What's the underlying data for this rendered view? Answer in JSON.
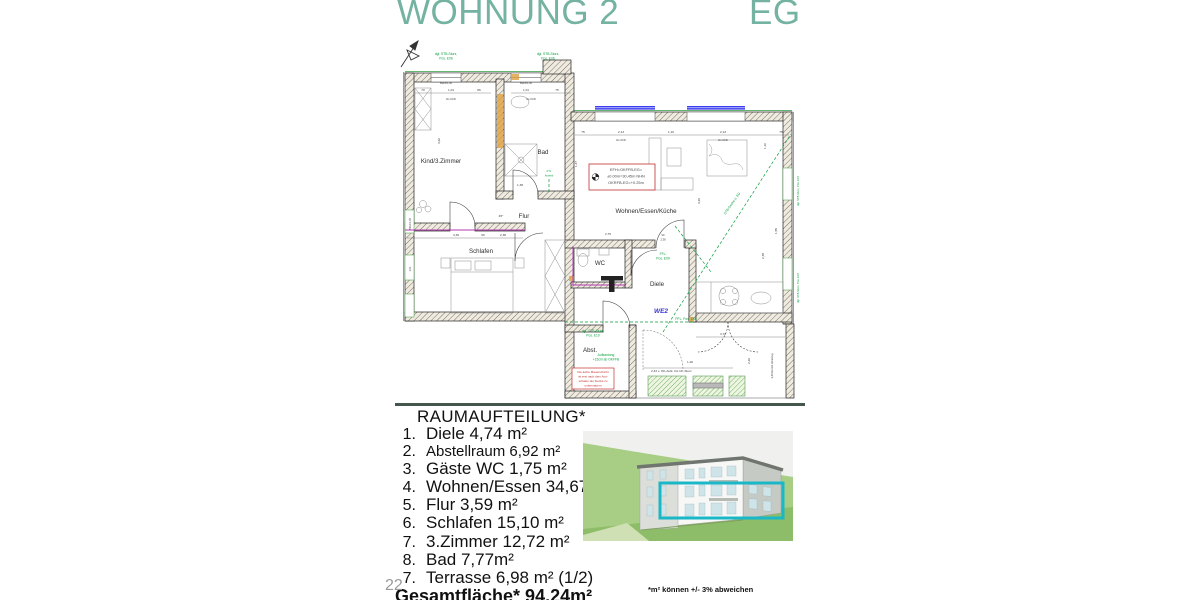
{
  "header": {
    "title": "WOHNUNG 2",
    "floor": "EG"
  },
  "room_list": {
    "heading": "RAUMAUFTEILUNG*",
    "items": [
      {
        "num": "1.",
        "text": "Diele 4,74 m²"
      },
      {
        "num": "2.",
        "text": "Abstellraum 6,92 m²"
      },
      {
        "num": "3.",
        "text": "Gäste WC 1,75 m²"
      },
      {
        "num": "4.",
        "text": "Wohnen/Essen 34,67 m²"
      },
      {
        "num": "5.",
        "text": "Flur 3,59 m²"
      },
      {
        "num": "6.",
        "text": "Schlafen 15,10 m²"
      },
      {
        "num": "7.",
        "text": "3.Zimmer 12,72 m²"
      },
      {
        "num": "8.",
        "text": "Bad 7,77m²"
      },
      {
        "num": "7.",
        "text": "Terrasse 6,98 m² (1/2)"
      }
    ],
    "total": "Gesamtfläche* 94,24m²"
  },
  "footnote": "*m² können +/- 3% abweichen",
  "page_number": "22",
  "floor_plan": {
    "rooms": {
      "kind": "Kind/3.Zimmer",
      "bad": "Bad",
      "flur": "Flur",
      "schlafen": "Schlafen",
      "wc": "WC",
      "diele": "Diele",
      "wohnen": "Wohnen/Essen/Küche",
      "abst": "Abst.",
      "we": "WE2"
    },
    "green": {
      "e06a": "dgl. STB-Sturz,",
      "e06b": "Pos. E06",
      "e07": "dgl. STB-Sturz, Pos. E07",
      "e10a": "dgl. STB-Sturz,",
      "e10b": "Pos. E10",
      "ffla": "FFL,",
      "fflb": "Pos. E09",
      "pfl": "PFL, Pos. E08",
      "ftla": "FTL",
      "ftlb": "Antrieb",
      "aufka": "Aufkantung",
      "aufkb": "+15cm ab OKFFB",
      "section": "STB-Decke ü. EG"
    },
    "level_box": [
      "EFH=OKFFB-EG=",
      "±0.00m=30,45m NHN",
      "OKRFB-EG=+0.25m"
    ],
    "warning": [
      "Die letzte Mauerschicht",
      "ist erst nach dem Aus-",
      "schalen der Decke zu",
      "untermauern"
    ],
    "dims": [
      "70",
      "1,01",
      "86",
      "1,01",
      "75",
      "BRH=1,00",
      "bis UKD",
      "75",
      "2,13",
      "1,10",
      "2,13",
      "3,39",
      "90",
      "2,38",
      "3,62",
      "1,38",
      "45°",
      "1,47",
      "3,26",
      "1,55",
      "3,72",
      "2,26",
      "1,20",
      "2,43 v. OK-Aufk. bis UK-Sturz",
      "3,49 bis UK-Unterzug",
      "2,38",
      "1,10",
      "2,75"
    ]
  },
  "colors": {
    "title_teal": "#74b2a1",
    "divider": "#45564c",
    "cad_green": "#0a9f3d",
    "window_blue": "#3c3cf0",
    "plumbing_magenta": "#b238b2",
    "accent_orange": "#e0a040",
    "note_red": "#c23030",
    "we_blue": "#3939d0",
    "highlight_teal": "#19b7c8"
  }
}
